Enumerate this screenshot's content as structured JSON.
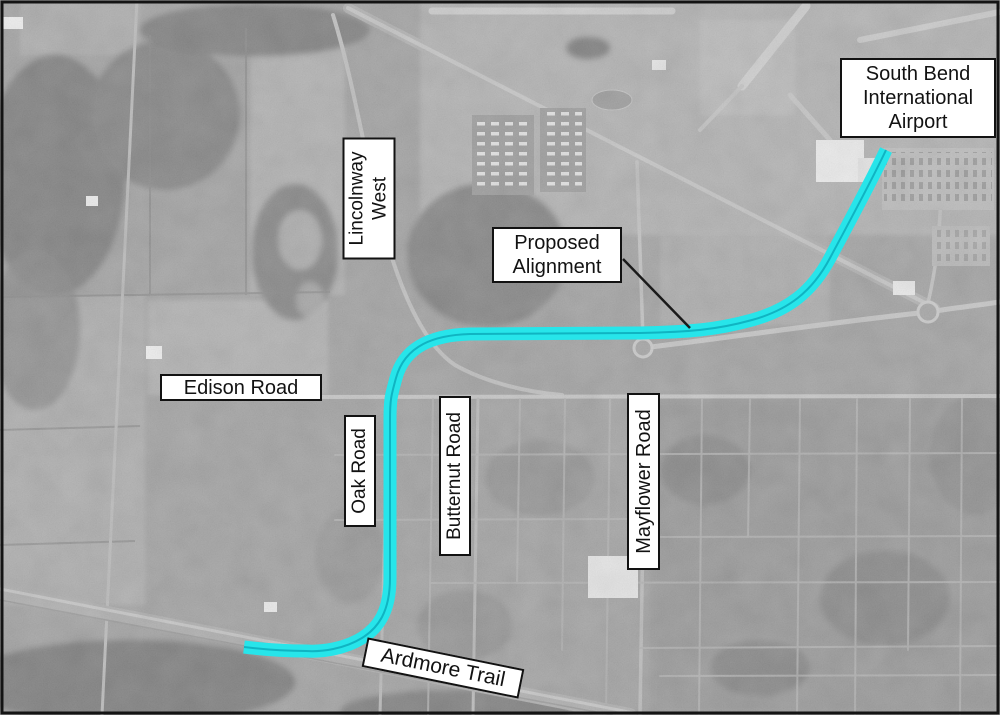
{
  "labels": {
    "airport": {
      "line1": "South Bend",
      "line2": "International",
      "line3": "Airport"
    },
    "lincolnway_west": {
      "line1": "Lincolnway",
      "line2": "West"
    },
    "proposed_alignment": {
      "line1": "Proposed",
      "line2": "Alignment"
    },
    "edison_road": {
      "text": "Edison Road"
    },
    "oak_road": {
      "text": "Oak Road"
    },
    "butternut_road": {
      "text": "Butternut Road"
    },
    "mayflower_road": {
      "text": "Mayflower Road"
    },
    "ardmore_trail": {
      "text": "Ardmore Trail"
    }
  },
  "colors": {
    "route": "#27e5ea",
    "route_centerline": "#10b4c2",
    "leader_line": "#1a1a1a",
    "map_border": "#141414",
    "label_border": "#121212",
    "label_background": "#ffffff"
  }
}
